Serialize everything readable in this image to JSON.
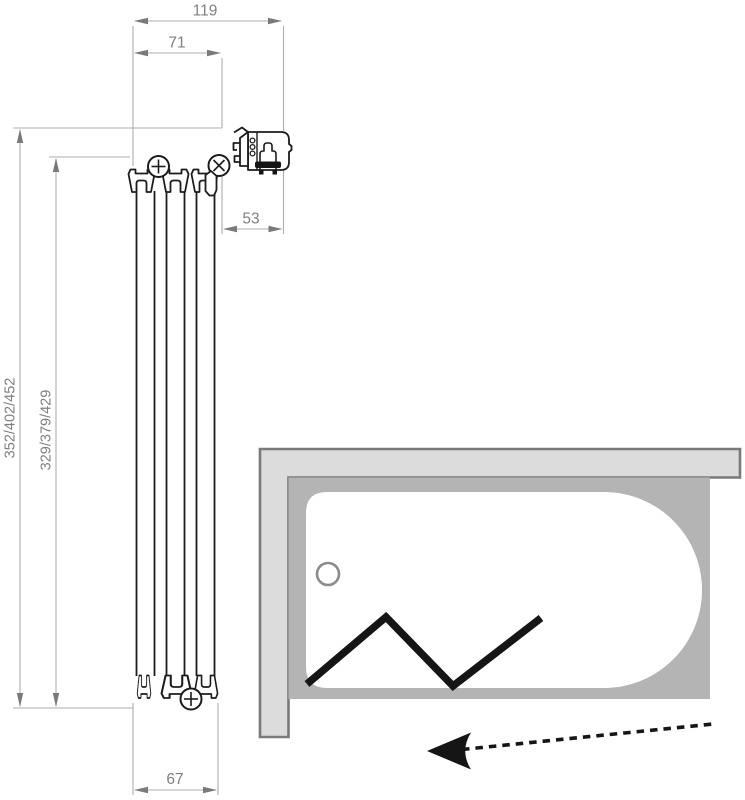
{
  "drawing": {
    "kind": "technical dimension drawing of a folding bath screen with bathtub plan view"
  },
  "dimensions": {
    "top_total": "119",
    "top_inner": "71",
    "wall_profile_offset": "53",
    "height_range_outer": "352/402/452",
    "height_range_inner": "329/379/429",
    "bottom_profile_width": "67"
  },
  "icons": {
    "hinge": "circle-cross-screw",
    "fold_direction": "dashed-arrow-left",
    "folded_screen": "zigzag-line",
    "drain": "small-circle"
  },
  "colors": {
    "dimension_line": "#aeaeae",
    "dimension_arrow": "#7a7a7a",
    "dimension_text": "#7f7f7f",
    "profile_outline": "#1c1c1c",
    "wall_band_fill": "#dcdcdc",
    "tub_rim_fill": "#b4b4b4",
    "tub_outline": "#7a7a7a",
    "tub_interior_fill": "#ffffff",
    "screen_black": "#151515"
  }
}
